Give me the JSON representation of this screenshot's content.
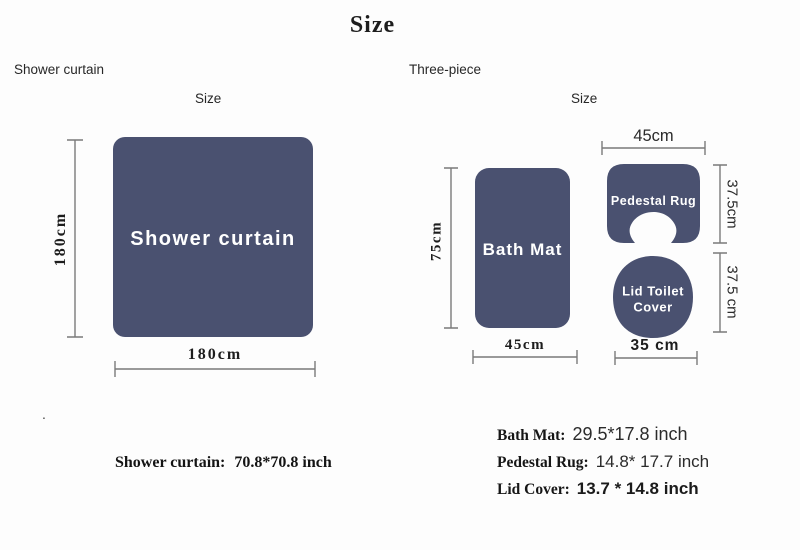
{
  "title": "Size",
  "colors": {
    "fabric": "#4a5170",
    "dim_line": "#7a7a7a"
  },
  "left": {
    "section_label": "Shower curtain",
    "size_label": "Size",
    "item_label": "Shower curtain",
    "height_dim": "180cm",
    "width_dim": "180cm",
    "stray_dot": ".",
    "footnote_label": "Shower curtain:",
    "footnote_value": "70.8*70.8 inch"
  },
  "right": {
    "section_label": "Three-piece",
    "size_label": "Size",
    "bath_mat": {
      "label": "Bath Mat",
      "height_dim": "75cm",
      "width_dim": "45cm"
    },
    "pedestal_rug": {
      "label": "Pedestal Rug",
      "width_dim": "45cm",
      "height_dim": "37.5cm"
    },
    "lid_cover": {
      "label_line1": "Lid Toilet",
      "label_line2": "Cover",
      "height_dim": "37.5 cm",
      "width_dim": "35 cm"
    },
    "footnotes": [
      {
        "label": "Bath Mat:",
        "value": "29.5*17.8 inch"
      },
      {
        "label": "Pedestal Rug:",
        "value": "14.8* 17.7 inch"
      },
      {
        "label": "Lid Cover:",
        "value": "13.7 * 14.8 inch"
      }
    ]
  }
}
